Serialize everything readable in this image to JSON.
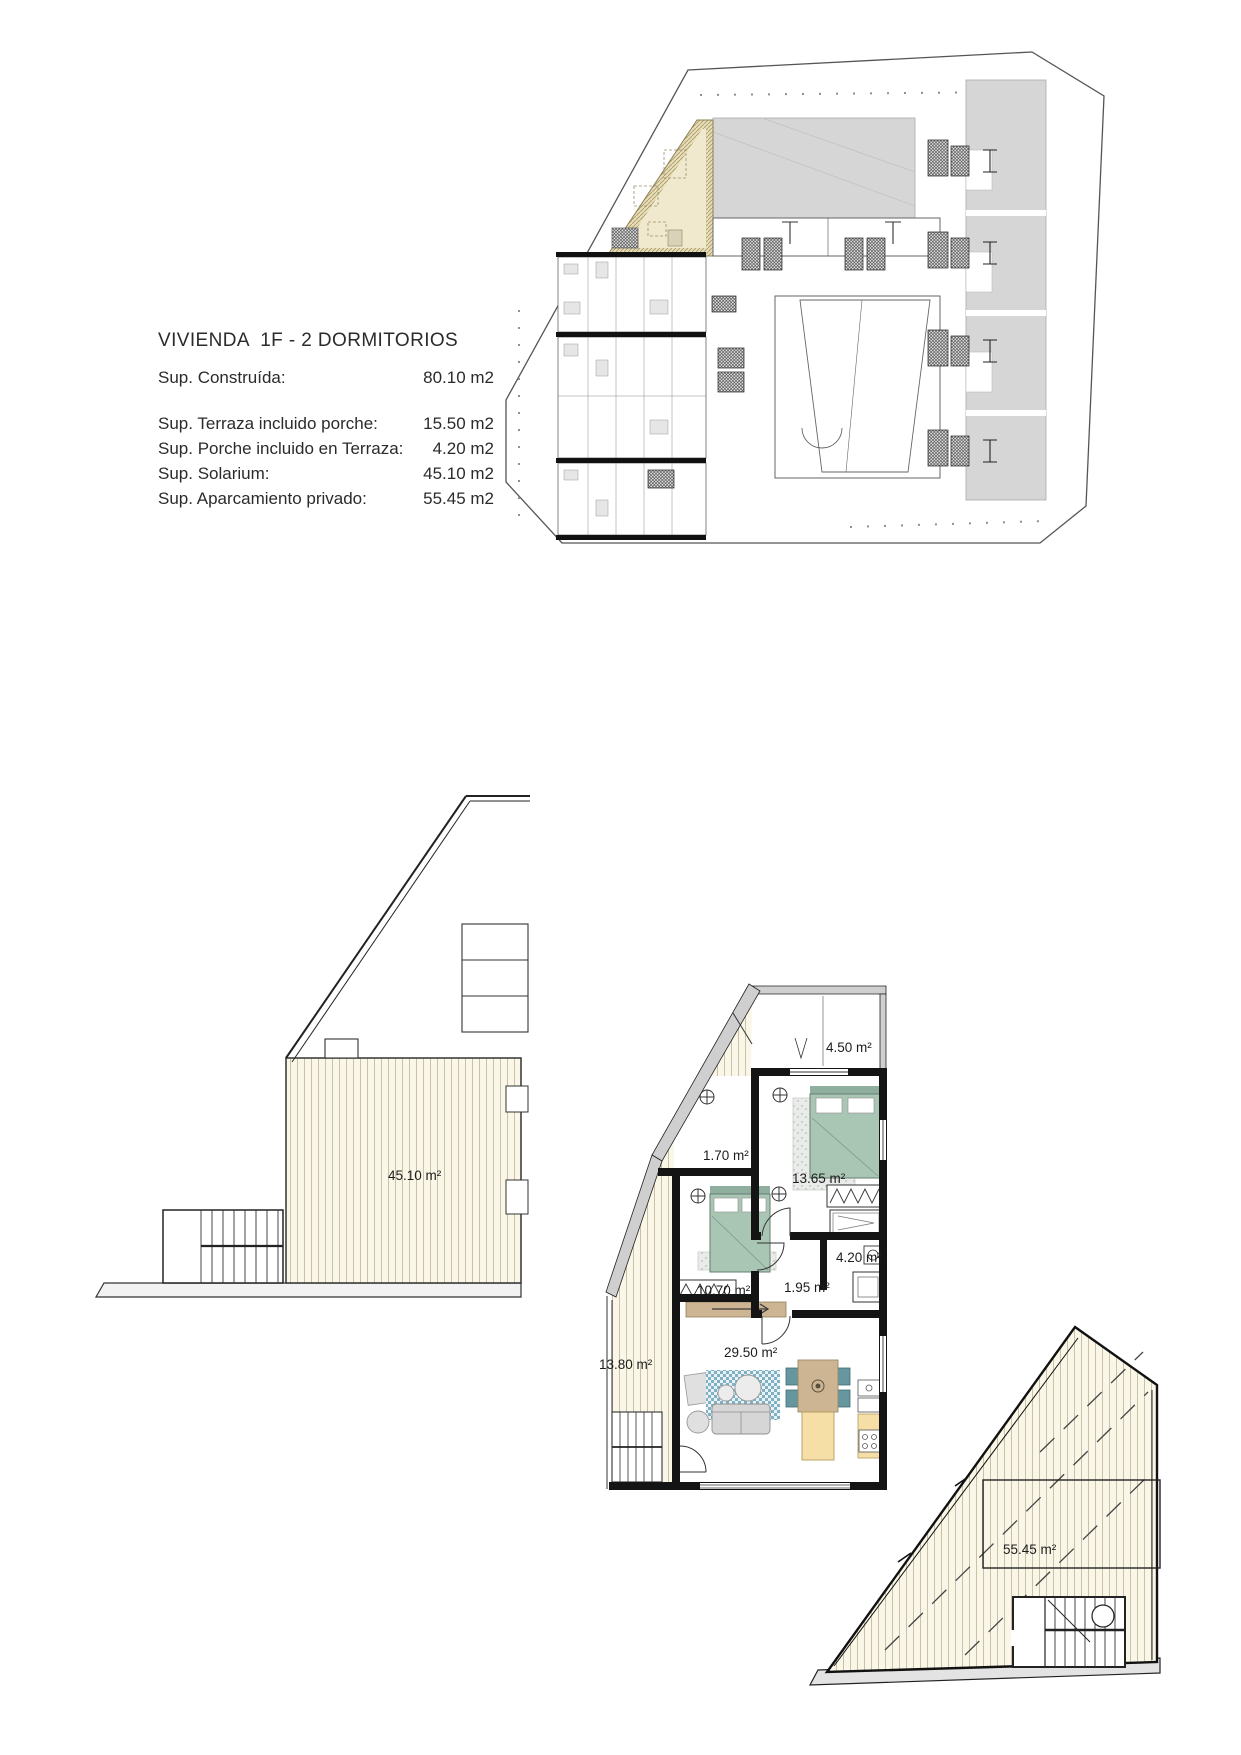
{
  "document": {
    "background": "#ffffff",
    "kind": "architectural floor plan sheet"
  },
  "info_block": {
    "title": "VIVIENDA  1F - 2 DORMITORIOS",
    "rows": [
      {
        "label": "Sup. Construída:",
        "value": "80.10 m2"
      },
      {
        "label": "Sup. Terraza incluido porche:",
        "value": "15.50 m2"
      },
      {
        "label": "Sup. Porche incluido en Terraza:",
        "value": "4.20 m2"
      },
      {
        "label": "Sup. Solarium:",
        "value": "45.10 m2"
      },
      {
        "label": "Sup. Aparcamiento privado:",
        "value": "55.45 m2"
      }
    ]
  },
  "plans": {
    "site": {
      "description": "key plan with highlighted unit"
    },
    "solarium": {
      "area": "45.10 m²"
    },
    "main": {
      "rooms": [
        {
          "name": "terraza-superior",
          "area": "4.50 m²"
        },
        {
          "name": "terraza-franja",
          "area": "1.70 m²"
        },
        {
          "name": "dormitorio-1",
          "area": "13.65 m²"
        },
        {
          "name": "dormitorio-2",
          "area": "10.70 m²"
        },
        {
          "name": "bano",
          "area": "4.20 m²"
        },
        {
          "name": "distribuidor",
          "area": "1.95 m²"
        },
        {
          "name": "salon-cocina",
          "area": "29.50 m²"
        },
        {
          "name": "terraza-lateral",
          "area": "13.80 m²"
        }
      ]
    },
    "parking": {
      "area": "55.45 m²"
    }
  },
  "colors": {
    "highlight_unit_beige": "#f1e9cd",
    "roof_gray": "#d6d6d6",
    "deck_cream": "#faf7e8",
    "bed_green": "#a9c6b4",
    "rug_blue": "#7fb0c4",
    "chair_teal": "#66979f",
    "wood_tan": "#cdb593",
    "counter_yellow": "#f6dfa6",
    "wall_black": "#141414",
    "wall_poche_gray": "#cfcfcf"
  }
}
